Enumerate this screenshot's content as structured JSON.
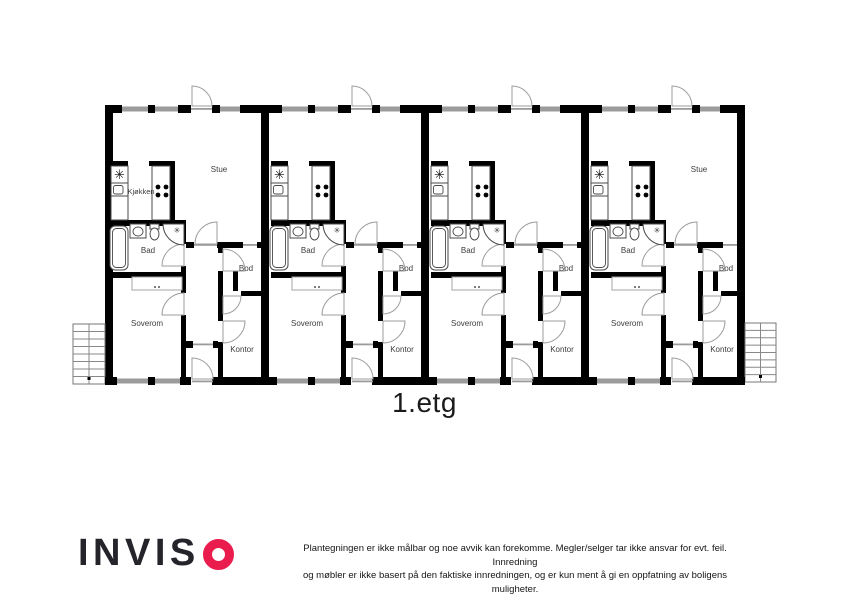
{
  "floor_label": "1.etg",
  "logo": {
    "name": "INVISO",
    "text_part": "INVIS",
    "o_letter": "O",
    "accent_color": "#ea1c4e",
    "text_color": "#26242b"
  },
  "disclaimer": {
    "line1": "Plantegningen er ikke målbar og noe avvik kan forekomme. Megler/selger tar ikke ansvar for evt. feil. Innredning",
    "line2": "og møbler er ikke basert på den faktiske innredningen, og er kun ment å gi en oppfatning av boligens muligheter."
  },
  "plan": {
    "wall_color": "#000000",
    "window_color": "#9b9b9b",
    "door_color": "#9e9e9e",
    "fixture_color": "#4a4a4a",
    "label_color": "#3c3c3c",
    "fridge_symbol": "✳",
    "shower_symbol": "✳",
    "units": [
      {
        "name": "apartment-1",
        "labels": {
          "kjokken": "Kjøkken",
          "stue": "Stue",
          "bad": "Bad",
          "bod": "Bod",
          "soverom": "Soverom",
          "kontor": "Kontor"
        }
      },
      {
        "name": "apartment-2",
        "labels": {
          "bad": "Bad",
          "bod": "Bod",
          "soverom": "Soverom",
          "kontor": "Kontor"
        }
      },
      {
        "name": "apartment-3",
        "labels": {
          "bad": "Bad",
          "bod": "Bod",
          "soverom": "Soverom",
          "kontor": "Kontor"
        }
      },
      {
        "name": "apartment-4",
        "labels": {
          "stue": "Stue",
          "bad": "Bad",
          "bod": "Bod",
          "soverom": "Soverom",
          "kontor": "Kontor"
        }
      }
    ]
  }
}
